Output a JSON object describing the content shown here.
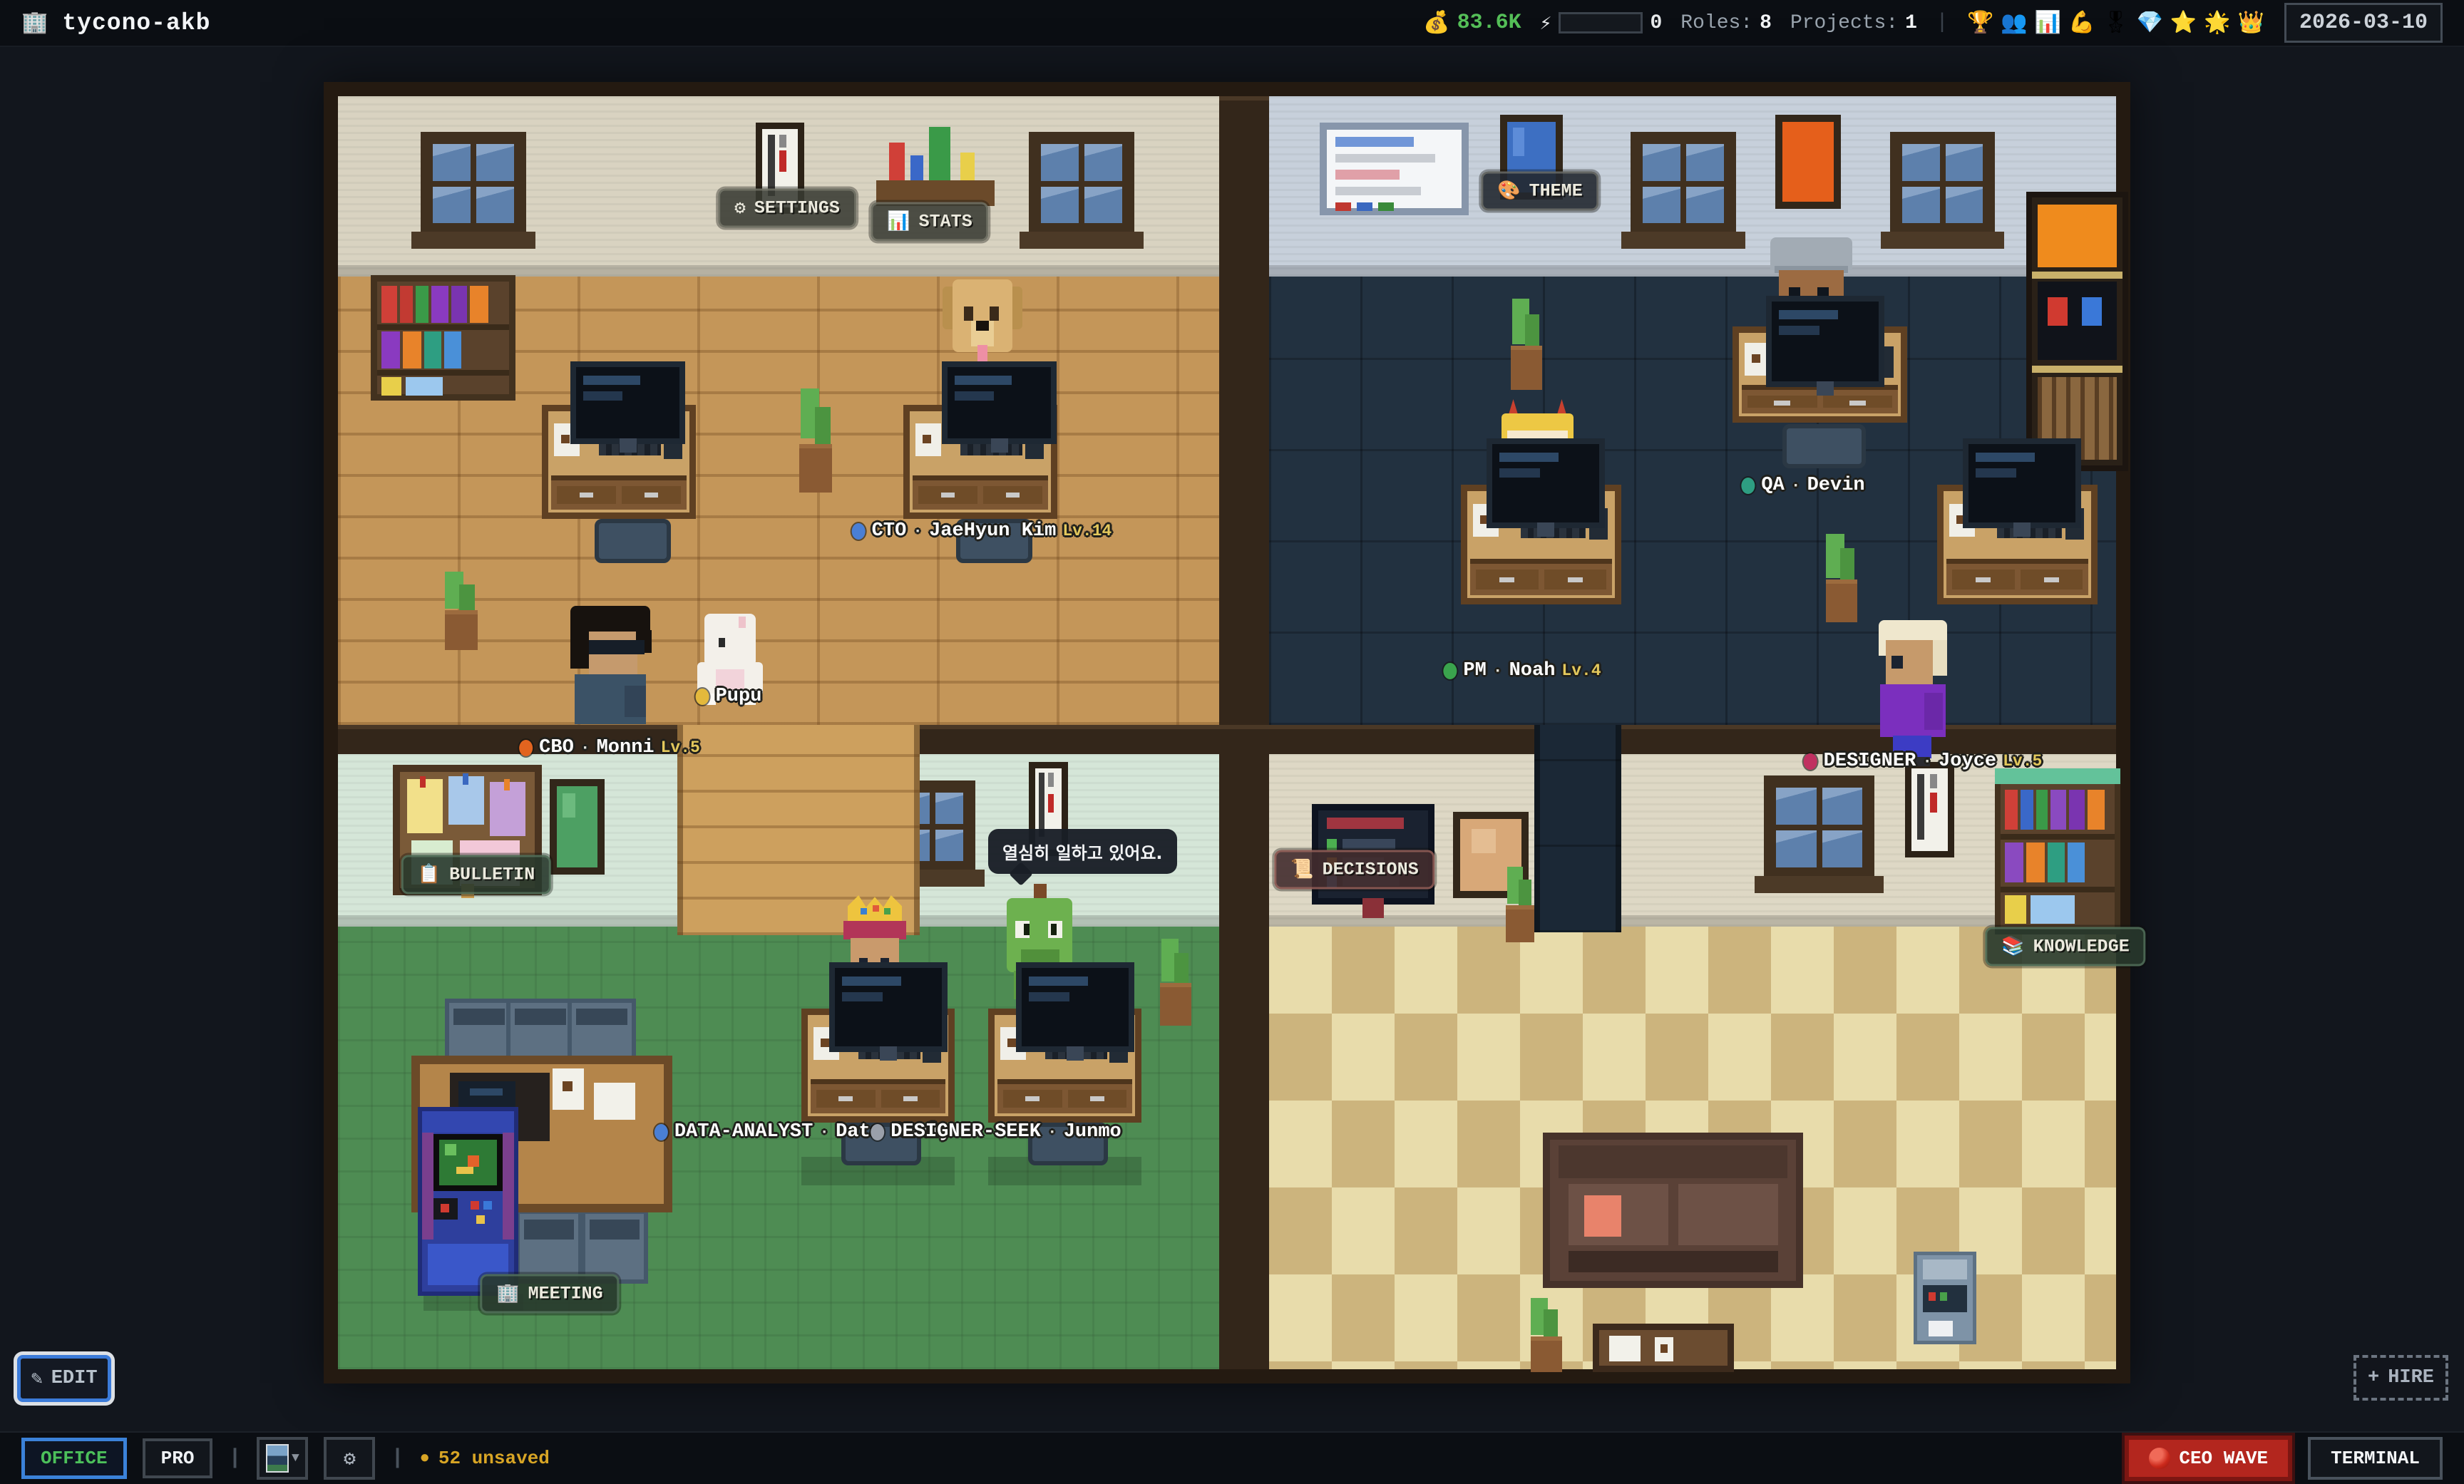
{
  "top_bar": {
    "app_icon": "🏢",
    "title": "tycono-akb",
    "money_icon": "💰",
    "money": "83.6K",
    "energy_icon": "⚡",
    "energy_value": "0",
    "roles_label": "Roles:",
    "roles_value": "8",
    "projects_label": "Projects:",
    "projects_value": "1",
    "badges": [
      "🏆",
      "👥",
      "📊",
      "💪",
      "🎖",
      "💎",
      "⭐",
      "🌟",
      "👑"
    ],
    "date": "2026-03-10"
  },
  "map": {
    "signs": {
      "settings": {
        "icon": "⚙",
        "label": "SETTINGS"
      },
      "stats": {
        "icon": "📊",
        "label": "STATS"
      },
      "theme": {
        "icon": "🎨",
        "label": "THEME"
      },
      "bulletin": {
        "icon": "📋",
        "label": "BULLETIN"
      },
      "decisions": {
        "icon": "📜",
        "label": "DECISIONS"
      },
      "knowledge": {
        "icon": "📚",
        "label": "KNOWLEDGE"
      },
      "meeting": {
        "icon": "🏢",
        "label": "MEETING"
      }
    },
    "name_tags": [
      {
        "dot": "#4a7fd4",
        "role": "CTO",
        "sep": "·",
        "name": "JaeHyun Kim",
        "lv": "Lv.14"
      },
      {
        "dot": "#e4b93c",
        "role": "",
        "sep": "",
        "name": "Pupu",
        "lv": ""
      },
      {
        "dot": "#e2641f",
        "role": "CBO",
        "sep": "·",
        "name": "Monni",
        "lv": "Lv.5"
      },
      {
        "dot": "#2e9e82",
        "role": "QA",
        "sep": "·",
        "name": "Devin",
        "lv": ""
      },
      {
        "dot": "#3aa34d",
        "role": "PM",
        "sep": "·",
        "name": "Noah",
        "lv": "Lv.4"
      },
      {
        "dot": "#c03060",
        "role": "DESIGNER",
        "sep": "·",
        "name": "Joyce",
        "lv": "Lv.5"
      },
      {
        "dot": "#4a7fd4",
        "role": "DATA-ANALYST",
        "sep": "·",
        "name": "Data Analy",
        "lv": ""
      },
      {
        "dot": "#9aa0aa",
        "role": "DESIGNER-SEEK",
        "sep": "·",
        "name": "Junmo",
        "lv": ""
      }
    ],
    "speech_bubble": {
      "text": "열심히 일하고 있어요."
    },
    "edit_button": {
      "icon": "✎",
      "label": "EDIT"
    },
    "hire_button": {
      "icon": "+",
      "label": "HIRE"
    }
  },
  "bottom_bar": {
    "office": "OFFICE",
    "pro": "PRO",
    "divider": "|",
    "scene_caret": "▼",
    "gear_icon": "⚙",
    "unsaved_dot": "●",
    "unsaved": "52 unsaved",
    "ceo_wave": "CEO WAVE",
    "terminal": "TERMINAL"
  },
  "colors": {
    "money_green": "#55bf58",
    "selected_tab_text": "#4cc05a",
    "selected_border": "#3b82d9",
    "unsaved_yellow": "#d8a525",
    "ceo_wave_red": "#b3261e",
    "level_yellow": "#e3c85c"
  }
}
